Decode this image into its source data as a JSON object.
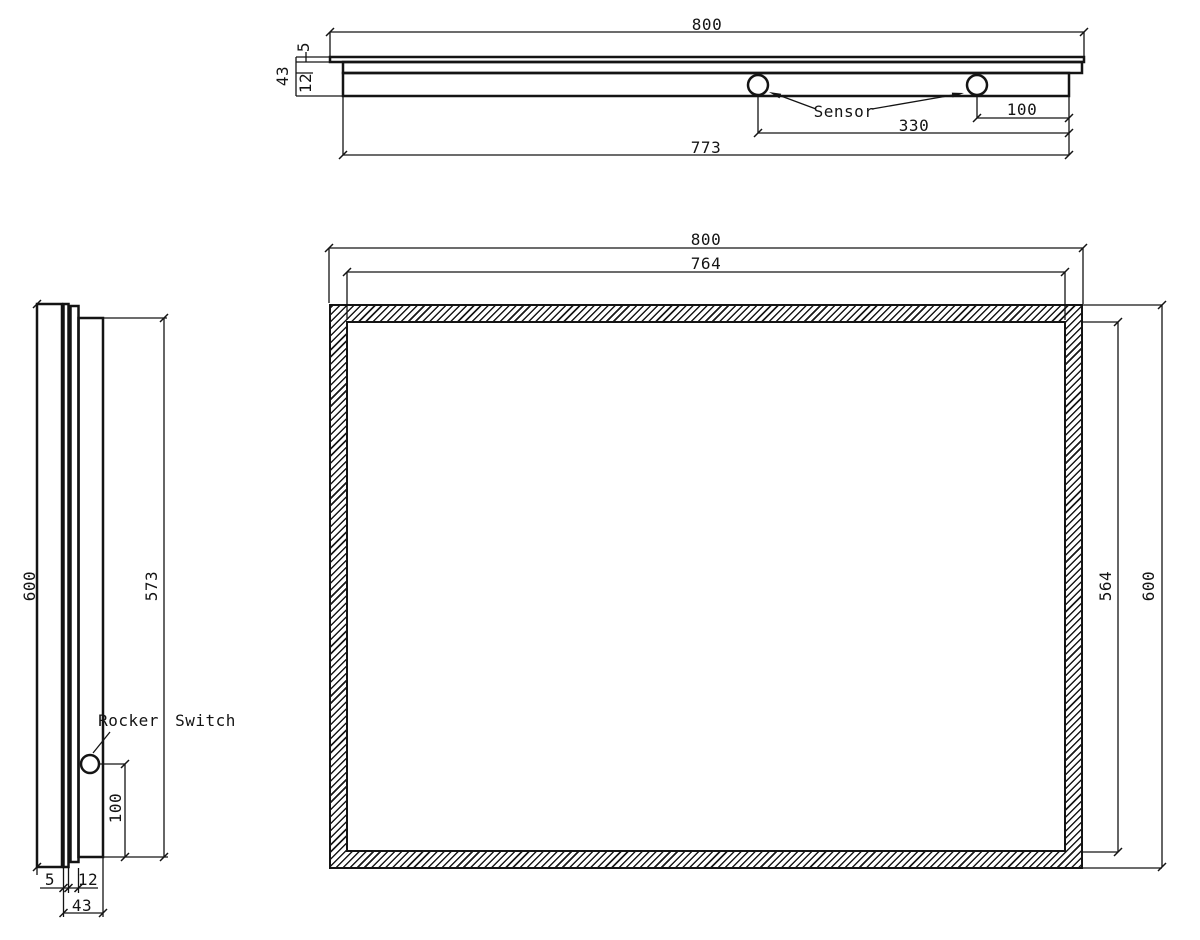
{
  "colors": {
    "line": "#141414",
    "background": "#ffffff"
  },
  "top_view": {
    "overall_width": "800",
    "glass_thickness": "5",
    "total_depth": "43",
    "layer_thickness": "12",
    "sensor_to_edge": "100",
    "sensor_span": "330",
    "body_width": "773",
    "sensor_label": "Sensor"
  },
  "side_view": {
    "overall_height": "600",
    "back_panel_height": "573",
    "switch_to_bottom": "100",
    "glass_thickness": "5",
    "layer_thickness": "12",
    "total_depth": "43",
    "switch_label": "Rocker Switch"
  },
  "front_view": {
    "overall_width": "800",
    "inner_width": "764",
    "inner_height": "564",
    "overall_height": "600"
  }
}
